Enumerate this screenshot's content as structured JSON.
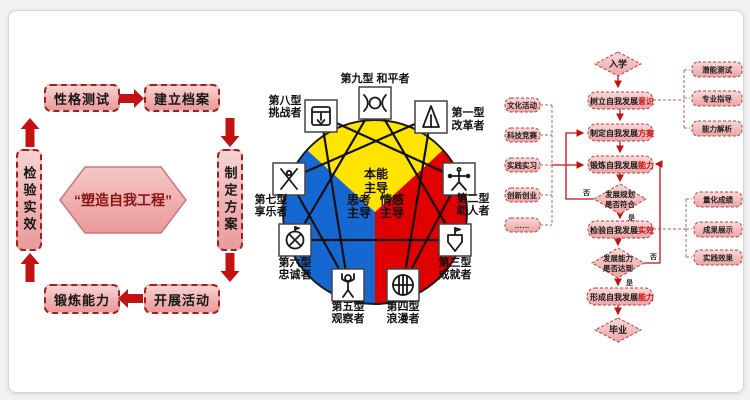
{
  "colors": {
    "box_pink": "#f2b6b6",
    "border_red": "#9c2222",
    "arrow_red": "#c41212",
    "enneagram_yellow": "#ffe400",
    "enneagram_blue": "#1567d2",
    "enneagram_red": "#e10000",
    "flow_accent_red": "#cc1111"
  },
  "cycle": {
    "center": "“塑造自我工程”",
    "top_left": "性格测试",
    "top_right": "建立档案",
    "right": "制定方案",
    "bottom_right": "开展活动",
    "bottom_left": "锻炼能力",
    "left": "检验实效"
  },
  "enneagram": {
    "top": "第九型 和平者",
    "types": [
      {
        "l1": "第一型",
        "l2": "改革者"
      },
      {
        "l1": "第二型",
        "l2": "助人者"
      },
      {
        "l1": "第三型",
        "l2": "成就者"
      },
      {
        "l1": "第四型",
        "l2": "浪漫者"
      },
      {
        "l1": "第五型",
        "l2": "观察者"
      },
      {
        "l1": "第六型",
        "l2": "忠诚者"
      },
      {
        "l1": "第七型",
        "l2": "享乐者"
      },
      {
        "l1": "第八型",
        "l2": "挑战者"
      }
    ],
    "centers": {
      "instinct_l1": "本能",
      "instinct_l2": "主导",
      "think_l1": "思考",
      "think_l2": "主导",
      "feel_l1": "情感",
      "feel_l2": "主导"
    }
  },
  "flowchart": {
    "start": "入学",
    "end": "毕业",
    "yes": "是",
    "no": "否",
    "main": [
      {
        "prefix": "树立自我发展",
        "suffix": "意识"
      },
      {
        "prefix": "制定自我发展",
        "suffix": "方案"
      },
      {
        "prefix": "锻炼自我发展",
        "suffix": "能力"
      },
      {
        "prefix": "检验自我发展",
        "suffix": "实效"
      },
      {
        "prefix": "形成自我发展",
        "suffix": "能力"
      }
    ],
    "d1": {
      "k1": "发展",
      "k2": "规划",
      "line2": "是否符合"
    },
    "d2": {
      "k1": "发展",
      "k2": "能力",
      "line2": "是否达到"
    },
    "left_items": [
      "文化活动",
      "科技竞赛",
      "实践实习",
      "创新创业",
      "……"
    ],
    "right_top": [
      "潜能测试",
      "专业指导",
      "能力解析"
    ],
    "right_mid": [
      "量化成绩",
      "成果展示",
      "实践效果"
    ]
  }
}
